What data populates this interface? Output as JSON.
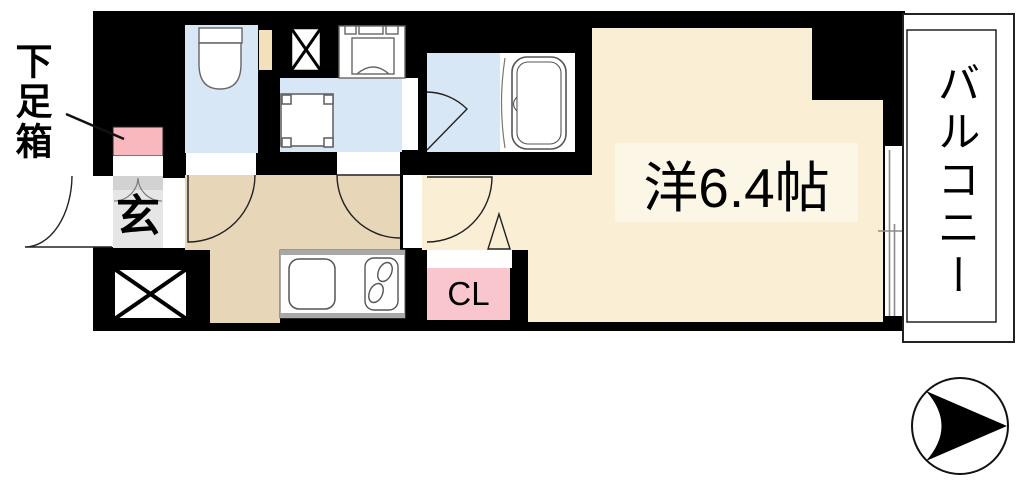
{
  "plan": {
    "rooms": {
      "main_room": {
        "label": "洋6.4帖",
        "size_tatami": "6.4帖",
        "type": "western-style room"
      },
      "balcony": {
        "label": "バルコニー"
      },
      "entrance": {
        "label": "玄"
      },
      "closet": {
        "label": "CL"
      },
      "shoe_box": {
        "label": "下足箱"
      }
    },
    "colors": {
      "wall": "#000000",
      "room_floor": "#FAEFD4",
      "room_label_bg": "#FCF6E6",
      "hallway_floor": "#E7D6B8",
      "wet_area_floor": "#D8E7F5",
      "closet_pink": "#F8C6CC",
      "shoe_box_pink": "#F9B7BE",
      "entrance_gray": "#E6E6E6",
      "entrance_step_gray": "#D2D2D2",
      "pipe_space_cream": "#F3E1BC",
      "counter_edge_gray": "#A8A8A8",
      "window_line_gray": "#8C8C8C",
      "compass": "#000000"
    }
  }
}
